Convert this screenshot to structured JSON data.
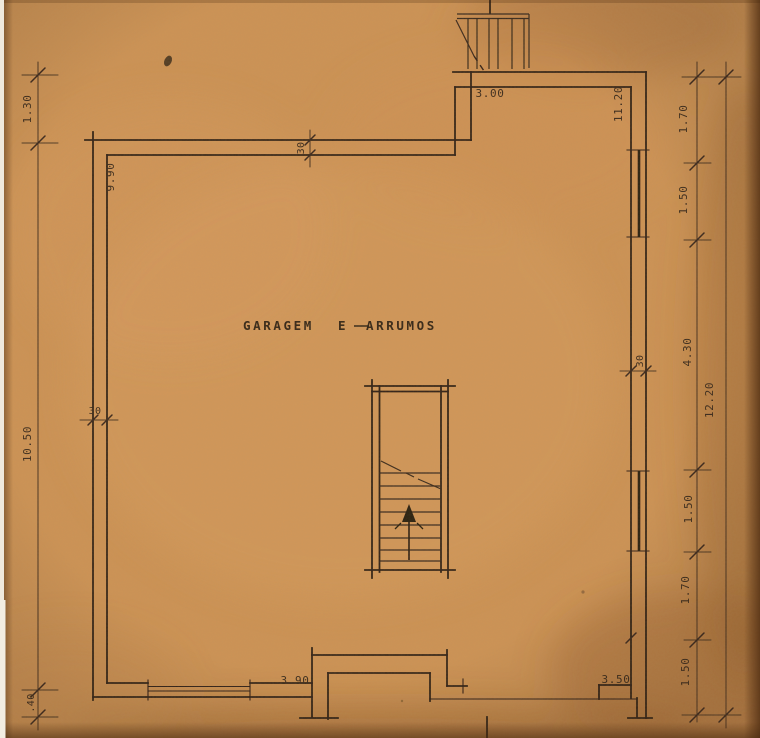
{
  "meta": {
    "kind": "architectural-floor-plan-blueprint-photo"
  },
  "room_label": {
    "word1": "GARAGEM",
    "word2": "E",
    "word3": "ARRUMOS"
  },
  "dimensions": {
    "left": {
      "top": "1.30",
      "main": "10.50",
      "bottom": ".40"
    },
    "top": {
      "left_wall": "9.90",
      "recess_width": "3.00",
      "right_wall": "11.20"
    },
    "right": {
      "segments": [
        "1.70",
        "1.50",
        "4.30",
        "1.50",
        "1.70",
        "1.50"
      ],
      "total": "12.20"
    },
    "bottom": {
      "left_opening": "3.90",
      "right_opening": "3.50"
    },
    "wall_thickness": {
      "top_wall": "30",
      "left_wall": "30",
      "right_wall": "30"
    }
  },
  "colors": {
    "paper": "#cd9355",
    "ink": "#2b1f14",
    "dim_line": "#4a3524",
    "label": "#34261a"
  }
}
